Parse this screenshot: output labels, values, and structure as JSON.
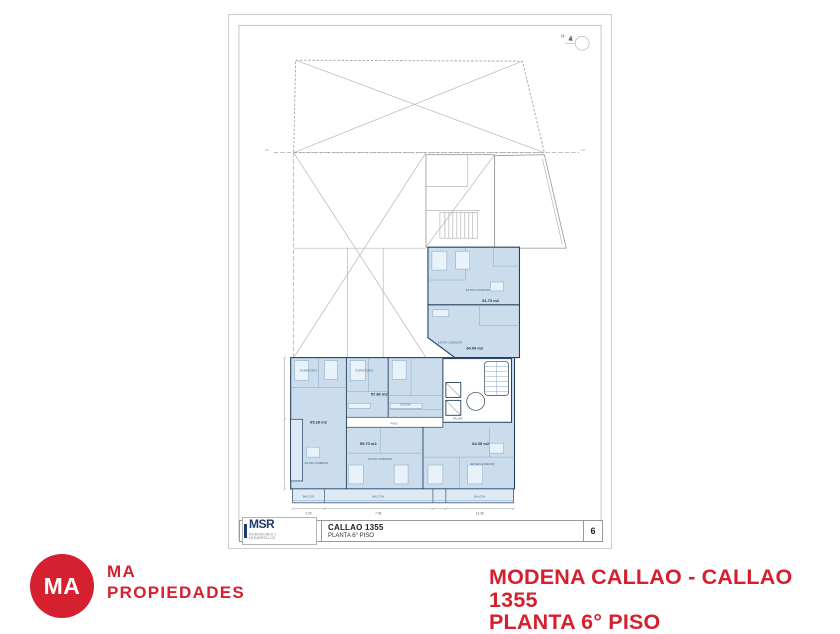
{
  "brand": {
    "circle_text": "MA",
    "name_top": "MA",
    "name_bottom": "PROPIEDADES"
  },
  "caption": {
    "line1": "MODENA CALLAO - CALLAO 1355",
    "line2": "PLANTA 6° PISO"
  },
  "sheet": {
    "north": "N",
    "axis_left": "LM",
    "axis_right": "LM",
    "titleblock": {
      "logo": "MSR",
      "logo_sub": "INVERSIONES Y DESARROLLOS",
      "project": "CALLAO 1355",
      "sheet_title": "PLANTA 6° PISO",
      "number": "6"
    },
    "units": [
      {
        "area": "61.70 m2"
      },
      {
        "area": "64.04 m2"
      },
      {
        "area": "57.80 m2"
      },
      {
        "area": "65.26 m2"
      },
      {
        "area": "59.70 m2"
      },
      {
        "area": "64.36 m2"
      }
    ],
    "labels": {
      "paso": "PASO",
      "palier": "PALIER",
      "balcon": "BALCON",
      "estar": "ESTAR COMEDOR",
      "dorm": "DORMITORIO",
      "cocina": "COCINA"
    },
    "dims": {
      "left": "2.90",
      "mid": "7.08",
      "right": "13.38"
    },
    "colors": {
      "unit_fill": "#cbdded",
      "balcony_fill": "#ddeaf6",
      "wall": "#24405e",
      "brand_red": "#d5202f",
      "msr_navy": "#1e3a6e"
    }
  }
}
